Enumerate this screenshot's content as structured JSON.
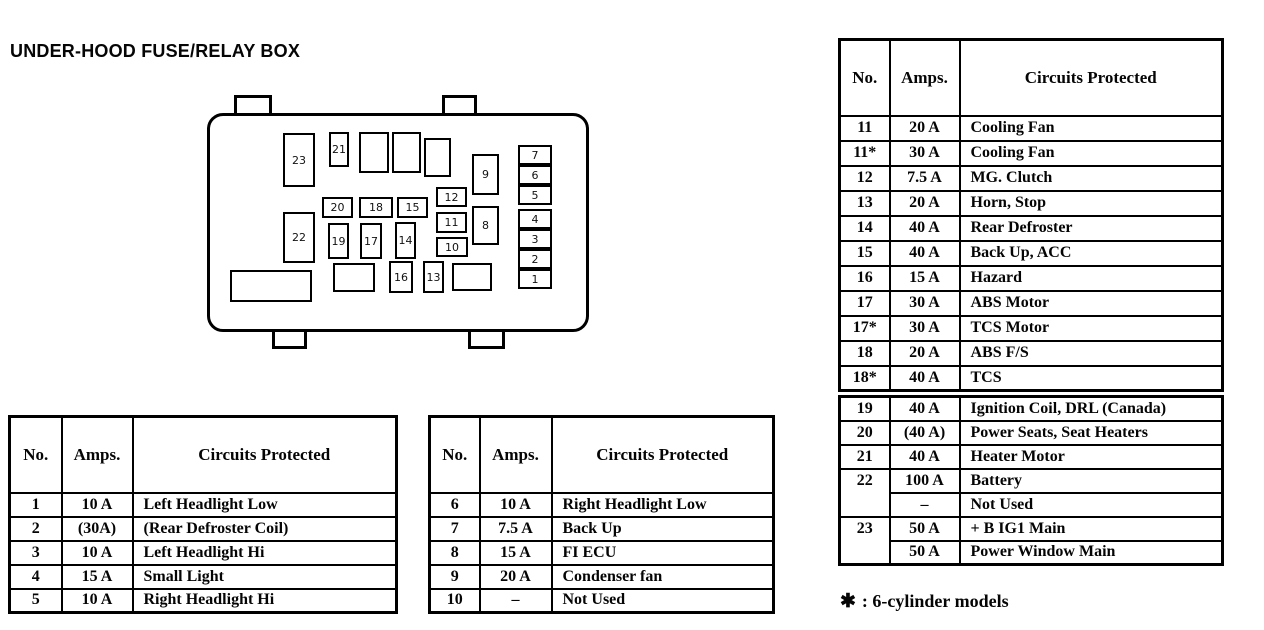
{
  "page": {
    "title": "UNDER-HOOD FUSE/RELAY BOX",
    "footnote_symbol": "✱",
    "footnote_text": ": 6-cylinder models",
    "ink_color": "#000000",
    "paper_color": "#ffffff"
  },
  "diagram": {
    "fuses": {
      "f23": "23",
      "f21": "21",
      "f9": "9",
      "f12": "12",
      "f11": "11",
      "f8": "8",
      "f10": "10",
      "f20": "20",
      "f18": "18",
      "f15": "15",
      "f22": "22",
      "f19": "19",
      "f17": "17",
      "f14": "14",
      "f16": "16",
      "f13": "13",
      "s7": "7",
      "s6": "6",
      "s5": "5",
      "s4": "4",
      "s3": "3",
      "s2": "2",
      "s1": "1"
    }
  },
  "tables": [
    {
      "name": "fuses-1-5",
      "headers": [
        "No.",
        "Amps.",
        "Circuits Protected"
      ],
      "rows": [
        [
          "1",
          "10 A",
          "Left Headlight Low"
        ],
        [
          "2",
          "(30A)",
          "(Rear Defroster Coil)"
        ],
        [
          "3",
          "10 A",
          "Left Headlight Hi"
        ],
        [
          "4",
          "15 A",
          "Small Light"
        ],
        [
          "5",
          "10 A",
          "Right Headlight Hi"
        ]
      ]
    },
    {
      "name": "fuses-6-10",
      "headers": [
        "No.",
        "Amps.",
        "Circuits Protected"
      ],
      "rows": [
        [
          "6",
          "10 A",
          "Right Headlight Low"
        ],
        [
          "7",
          "7.5 A",
          "Back Up"
        ],
        [
          "8",
          "15 A",
          "FI ECU"
        ],
        [
          "9",
          "20 A",
          "Condenser fan"
        ],
        [
          "10",
          "–",
          "Not Used"
        ]
      ]
    },
    {
      "name": "fuses-11-18",
      "headers": [
        "No.",
        "Amps.",
        "Circuits Protected"
      ],
      "rows": [
        [
          "11",
          "20 A",
          "Cooling Fan"
        ],
        [
          "11*",
          "30 A",
          "Cooling Fan"
        ],
        [
          "12",
          "7.5 A",
          "MG. Clutch"
        ],
        [
          "13",
          "20 A",
          "Horn, Stop"
        ],
        [
          "14",
          "40 A",
          "Rear Defroster"
        ],
        [
          "15",
          "40 A",
          "Back Up, ACC"
        ],
        [
          "16",
          "15 A",
          "Hazard"
        ],
        [
          "17",
          "30 A",
          "ABS Motor"
        ],
        [
          "17*",
          "30 A",
          "TCS Motor"
        ],
        [
          "18",
          "20 A",
          "ABS F/S"
        ],
        [
          "18*",
          "40 A",
          "TCS"
        ]
      ]
    },
    {
      "name": "fuses-19-23",
      "headers": null,
      "rows": [
        [
          "19",
          "40 A",
          "Ignition Coil, DRL (Canada)"
        ],
        [
          "20",
          "(40 A)",
          "Power Seats, Seat Heaters"
        ],
        [
          "21",
          "40 A",
          "Heater Motor"
        ],
        [
          {
            "t": "22",
            "rs": 2
          },
          "100 A",
          "Battery"
        ],
        [
          "–",
          "Not Used"
        ],
        [
          {
            "t": "23",
            "rs": 2
          },
          "50 A",
          "+ B IG1 Main"
        ],
        [
          "50 A",
          "Power Window Main"
        ]
      ]
    }
  ]
}
